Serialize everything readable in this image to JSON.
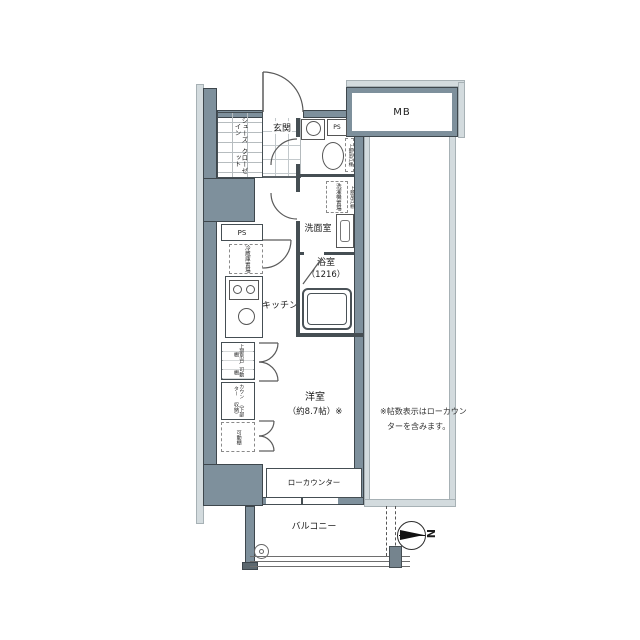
{
  "labels": {
    "mb": "MB",
    "ps_top": "PS",
    "ps_left": "PS",
    "genkan": "玄関",
    "shoes_in": "シューズイン",
    "closet": "クローゼット",
    "toilet_cabinet": "上部吊戸棚",
    "laundry_1": "洗濯機",
    "laundry_2": "置場",
    "laundry_cabinet": "上部吊戸棚",
    "washroom": "洗面室",
    "bath": "浴室",
    "bath_size": "（1216）",
    "kitchen": "キッチン",
    "fridge_1": "冷蔵庫",
    "fridge_2": "置場",
    "shelf_top_1": "上部吊戸棚",
    "shelf_top_2": "可動棚",
    "counter_1": "カウンター",
    "counter_2": "（下部収納）",
    "shelf_bottom": "可動棚",
    "room": "洋室",
    "room_size": "（約8.7帖）※",
    "low_counter": "ローカウンター",
    "balcony": "バルコニー",
    "north": "N",
    "note_1": "※帖数表示はローカウン",
    "note_2": "ターを含みます。"
  },
  "colors": {
    "wall_fill": "#7e909c",
    "wall_outline": "#3e474d",
    "exterior_band": "#d3dbde",
    "line": "#555555",
    "text": "#222222"
  }
}
